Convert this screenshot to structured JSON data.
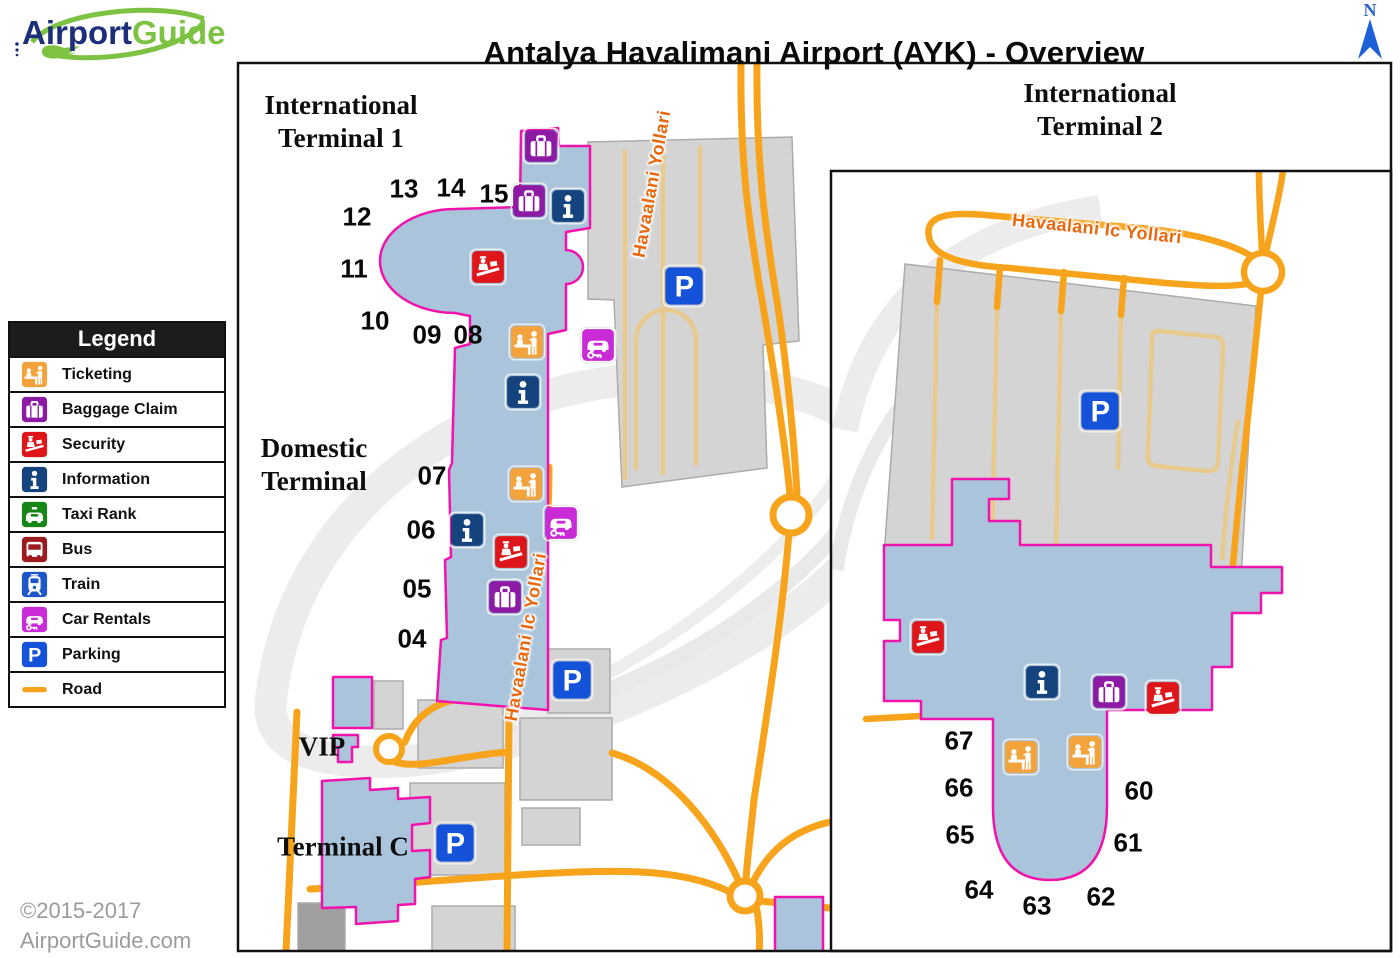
{
  "header": {
    "logo": {
      "part1": "Airport",
      "part2": "Guide"
    },
    "title": "Antalya Havalimani Airport (AYK) - Overview",
    "compass_label": "N"
  },
  "legend": {
    "title": "Legend",
    "items": [
      {
        "icon": "ticketing",
        "label": "Ticketing",
        "color": "#F2A33C"
      },
      {
        "icon": "baggage",
        "label": "Baggage Claim",
        "color": "#8C1AA3"
      },
      {
        "icon": "security",
        "label": "Security",
        "color": "#DE1619"
      },
      {
        "icon": "info",
        "label": "Information",
        "color": "#15437E"
      },
      {
        "icon": "taxi",
        "label": "Taxi Rank",
        "color": "#168716"
      },
      {
        "icon": "bus",
        "label": "Bus",
        "color": "#9C1B1E"
      },
      {
        "icon": "train",
        "label": "Train",
        "color": "#1C56C8"
      },
      {
        "icon": "car",
        "label": "Car Rentals",
        "color": "#C92BD6"
      },
      {
        "icon": "parking",
        "label": "Parking",
        "color": "#1452DA"
      },
      {
        "icon": "road",
        "label": "Road",
        "color": "#F7A41C"
      }
    ]
  },
  "map": {
    "colors": {
      "terminal_fill": "#A9C4DB",
      "terminal_outline": "#F213AC",
      "road": "#F7A41C",
      "building": "#D4D4D4",
      "parking_lane": "#E8CA8C",
      "road_label": "#E8680F"
    },
    "terminal_labels": [
      {
        "name": "international-terminal-1-label",
        "lines": [
          "International",
          "Terminal 1"
        ],
        "x": 341,
        "y": 122
      },
      {
        "name": "domestic-terminal-label",
        "lines": [
          "Domestic",
          "Terminal"
        ],
        "x": 314,
        "y": 465
      },
      {
        "name": "vip-label",
        "lines": [
          "VIP"
        ],
        "x": 322,
        "y": 747
      },
      {
        "name": "terminal-c-label",
        "lines": [
          "Terminal C"
        ],
        "x": 343,
        "y": 847
      },
      {
        "name": "international-terminal-2-label",
        "lines": [
          "International",
          "Terminal 2"
        ],
        "x": 1100,
        "y": 110
      }
    ],
    "road_labels": [
      {
        "name": "havaalani-yollari-label",
        "text": "Havaalani Yollari",
        "x": 652,
        "y": 184,
        "rot": -80
      },
      {
        "name": "havaalani-ic-yollari-label",
        "text": "Havaalani Ic Yollari",
        "x": 526,
        "y": 637,
        "rot": -80
      },
      {
        "name": "havaalani-ic-yollari-inset-label",
        "text": "Havaalani Ic Yollari",
        "x": 1097,
        "y": 229,
        "rot": 6
      }
    ],
    "gates": [
      {
        "n": "13",
        "x": 404,
        "y": 189
      },
      {
        "n": "14",
        "x": 451,
        "y": 188
      },
      {
        "n": "15",
        "x": 494,
        "y": 194
      },
      {
        "n": "12",
        "x": 357,
        "y": 217
      },
      {
        "n": "11",
        "x": 354,
        "y": 269
      },
      {
        "n": "10",
        "x": 375,
        "y": 321
      },
      {
        "n": "09",
        "x": 427,
        "y": 335
      },
      {
        "n": "08",
        "x": 468,
        "y": 335
      },
      {
        "n": "07",
        "x": 432,
        "y": 476
      },
      {
        "n": "06",
        "x": 421,
        "y": 530
      },
      {
        "n": "05",
        "x": 417,
        "y": 589
      },
      {
        "n": "04",
        "x": 412,
        "y": 639
      },
      {
        "n": "67",
        "x": 959,
        "y": 741
      },
      {
        "n": "66",
        "x": 959,
        "y": 788
      },
      {
        "n": "65",
        "x": 960,
        "y": 835
      },
      {
        "n": "64",
        "x": 979,
        "y": 890
      },
      {
        "n": "63",
        "x": 1037,
        "y": 906
      },
      {
        "n": "62",
        "x": 1101,
        "y": 897
      },
      {
        "n": "61",
        "x": 1128,
        "y": 843
      },
      {
        "n": "60",
        "x": 1139,
        "y": 791
      }
    ],
    "markers": [
      {
        "type": "baggage",
        "x": 541,
        "y": 146
      },
      {
        "type": "baggage",
        "x": 529,
        "y": 201
      },
      {
        "type": "info",
        "x": 568,
        "y": 206
      },
      {
        "type": "security",
        "x": 488,
        "y": 267
      },
      {
        "type": "ticketing",
        "x": 527,
        "y": 342
      },
      {
        "type": "car",
        "x": 598,
        "y": 345
      },
      {
        "type": "info",
        "x": 523,
        "y": 392
      },
      {
        "type": "ticketing",
        "x": 526,
        "y": 484
      },
      {
        "type": "car",
        "x": 561,
        "y": 523
      },
      {
        "type": "info",
        "x": 467,
        "y": 530
      },
      {
        "type": "security",
        "x": 511,
        "y": 552
      },
      {
        "type": "baggage",
        "x": 505,
        "y": 597
      },
      {
        "type": "parking",
        "x": 684,
        "y": 286
      },
      {
        "type": "parking",
        "x": 572,
        "y": 680
      },
      {
        "type": "parking",
        "x": 455,
        "y": 843
      },
      {
        "type": "parking",
        "x": 1100,
        "y": 411
      },
      {
        "type": "security",
        "x": 928,
        "y": 637
      },
      {
        "type": "info",
        "x": 1042,
        "y": 682
      },
      {
        "type": "baggage",
        "x": 1109,
        "y": 692
      },
      {
        "type": "security",
        "x": 1163,
        "y": 698
      },
      {
        "type": "ticketing",
        "x": 1021,
        "y": 757
      },
      {
        "type": "ticketing",
        "x": 1085,
        "y": 752
      }
    ]
  },
  "footer": {
    "line1": "©2015-2017",
    "line2": "AirportGuide.com"
  }
}
